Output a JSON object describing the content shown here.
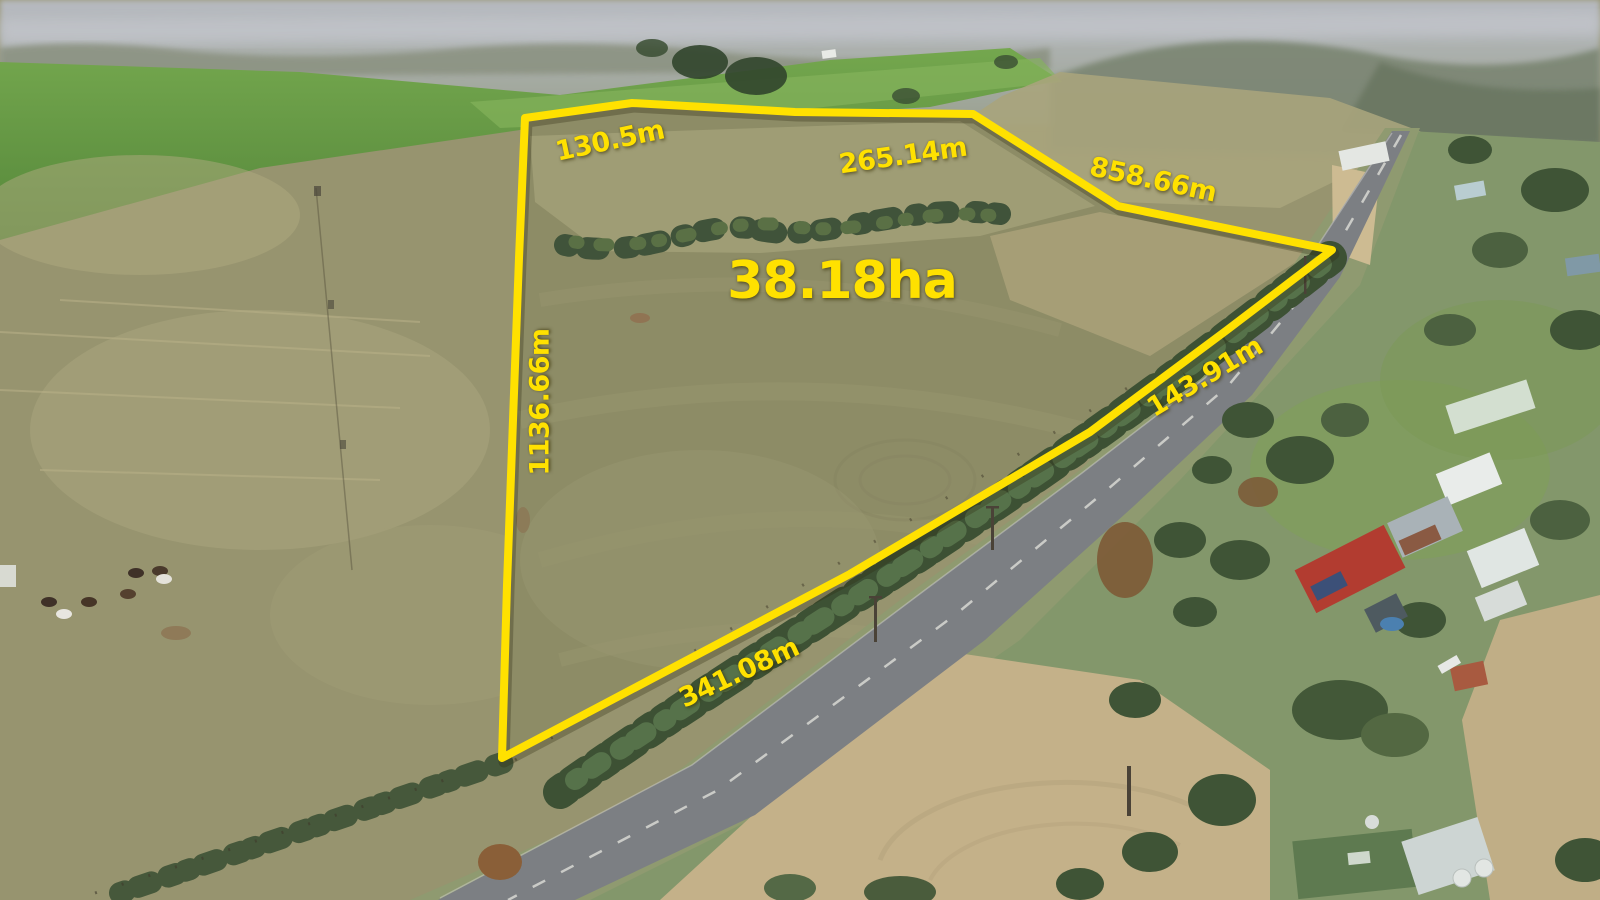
{
  "title": "Aerial drone photo of rural land parcel with surveyed boundary overlay",
  "annotations": {
    "area_label": "38.18ha",
    "boundary_color": "#ffe100",
    "measurements": [
      {
        "id": "north-west-edge",
        "text": "130.5m"
      },
      {
        "id": "north-edge",
        "text": "265.14m"
      },
      {
        "id": "north-east-edge",
        "text": "858.66m"
      },
      {
        "id": "west-edge",
        "text": "1136.66m"
      },
      {
        "id": "road-frontage-upper",
        "text": "143.91m"
      },
      {
        "id": "road-frontage-lower",
        "text": "341.08m"
      }
    ]
  },
  "scene": {
    "description": "Hazy distant township and hills at top, bright green crop hills, dry olive pasture paddocks, yellow surveyed parcel outline beside a sealed road lined with trees, rural houses and sheds to the east, cattle grazing in the western paddock",
    "features": [
      "hazy horizon",
      "green crop hills",
      "dry pasture",
      "tree windbreaks",
      "sealed road with centerline",
      "rural houses and sheds",
      "red roof house",
      "water tanks",
      "cattle",
      "power poles"
    ],
    "colors": {
      "pasture_olive": "#8d8c66",
      "crop_green": "#5f9340",
      "dry_tan": "#c4b189",
      "road_gray": "#7c7f83",
      "tree_green": "#3d5134",
      "haze_gray": "#b0b4ba",
      "boundary_yellow": "#ffe100"
    }
  }
}
